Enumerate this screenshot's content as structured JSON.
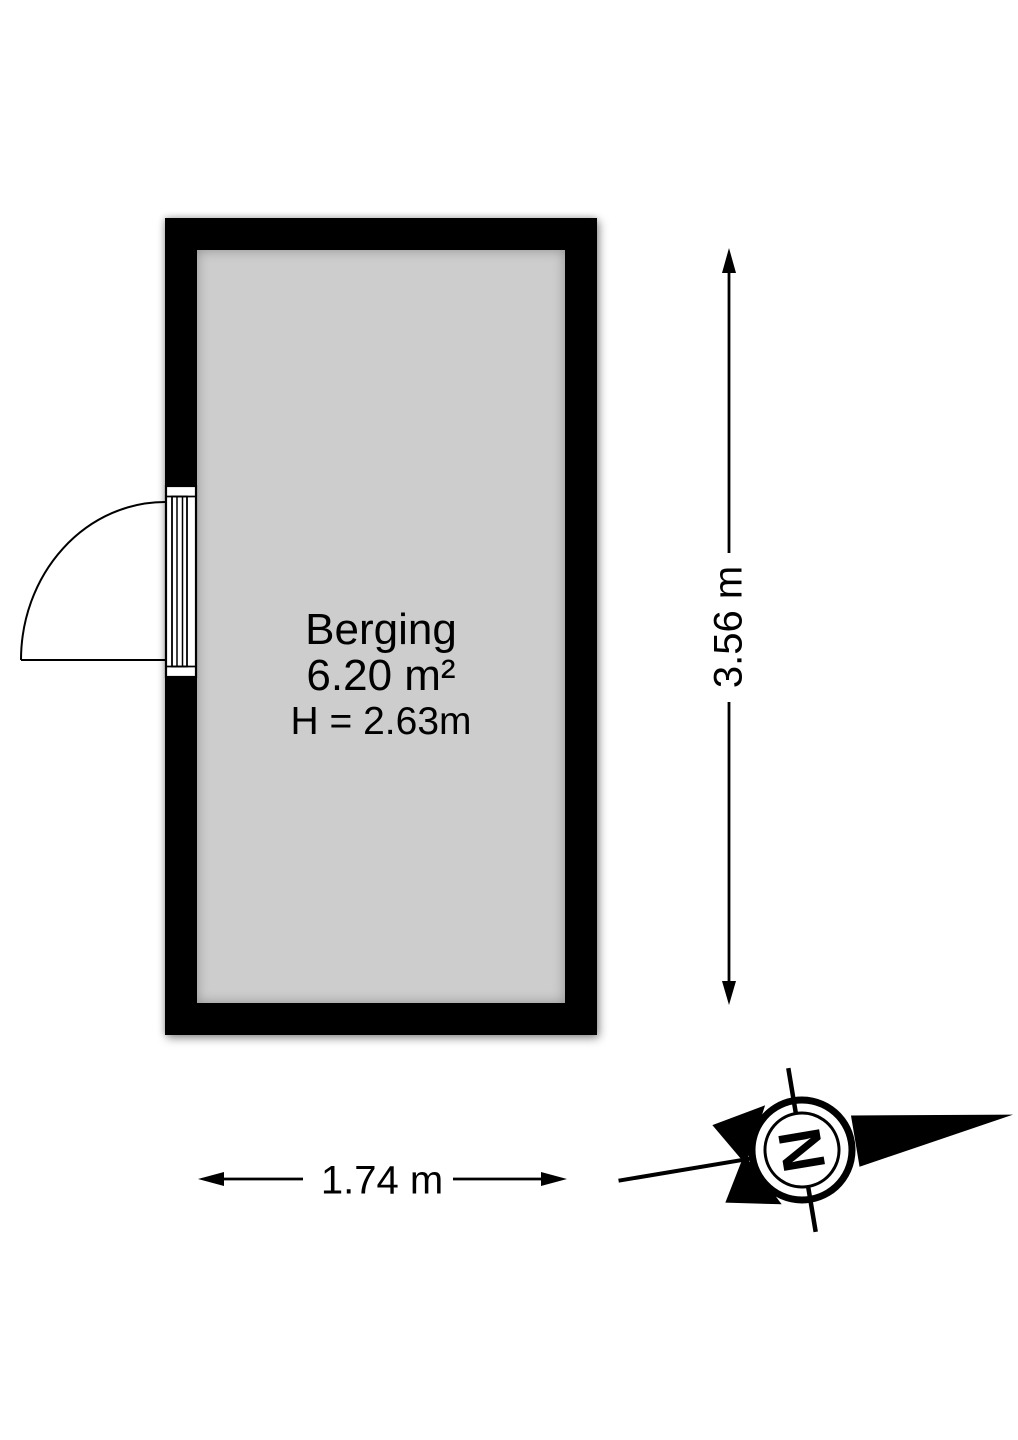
{
  "floorplan": {
    "room": {
      "name": "Berging",
      "area": "6.20 m²",
      "ceiling_height": "H = 2.63m"
    },
    "dimensions": {
      "vertical_label": "3.56 m",
      "horizontal_label": "1.74 m"
    },
    "compass": {
      "north_label": "N"
    },
    "colors": {
      "wall": "#000000",
      "floor": "#cdcdcd",
      "background": "#ffffff",
      "line": "#000000"
    }
  }
}
